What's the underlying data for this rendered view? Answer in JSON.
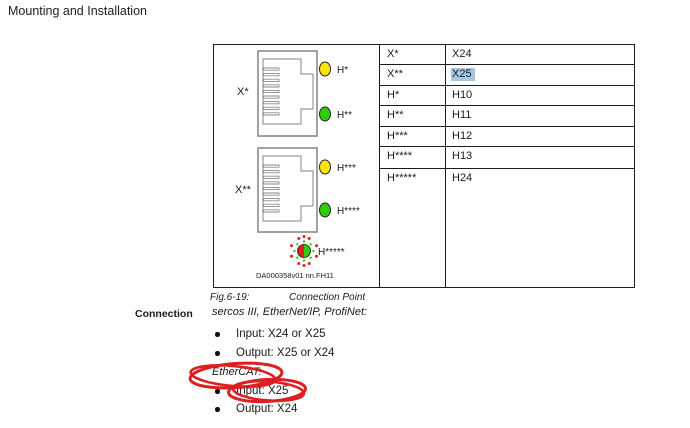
{
  "page": {
    "header": "Mounting and Installation"
  },
  "figure": {
    "connector_labels": [
      "X*",
      "X**"
    ],
    "led_labels": [
      "H*",
      "H**",
      "H***",
      "H****",
      "H*****"
    ],
    "drawing_number": "DA000358v01  nn.FH11"
  },
  "table": {
    "rows": [
      {
        "key": "X*",
        "value": "X24",
        "highlighted": false
      },
      {
        "key": "X**",
        "value": "X25",
        "highlighted": true
      },
      {
        "key": "H*",
        "value": "H10",
        "highlighted": false
      },
      {
        "key": "H**",
        "value": "H11",
        "highlighted": false
      },
      {
        "key": "H***",
        "value": "H12",
        "highlighted": false
      },
      {
        "key": "H****",
        "value": "H13",
        "highlighted": false
      },
      {
        "key": "H*****",
        "value": "H24",
        "highlighted": false
      }
    ]
  },
  "caption": {
    "fig_label": "Fig.6-19:",
    "fig_title": "Connection Point"
  },
  "connection": {
    "margin_label": "Connection",
    "protocols_heading": "sercos III, EtherNet/IP, ProfiNet:",
    "protocol_items": [
      "Input: X24 or X25",
      "Output: X25 or X24"
    ],
    "ethercat_heading": "EtherCAT:",
    "ethercat_items": [
      "Input: X25",
      "Output: X24"
    ]
  },
  "colors": {
    "led_yellow": "#ffe600",
    "led_green": "#33cc0a",
    "led_red": "#dd2020",
    "highlight_blue": "#a8c6e4",
    "annotation_red": "#dd1f1f",
    "housing_gray": "#8a8a8a"
  }
}
